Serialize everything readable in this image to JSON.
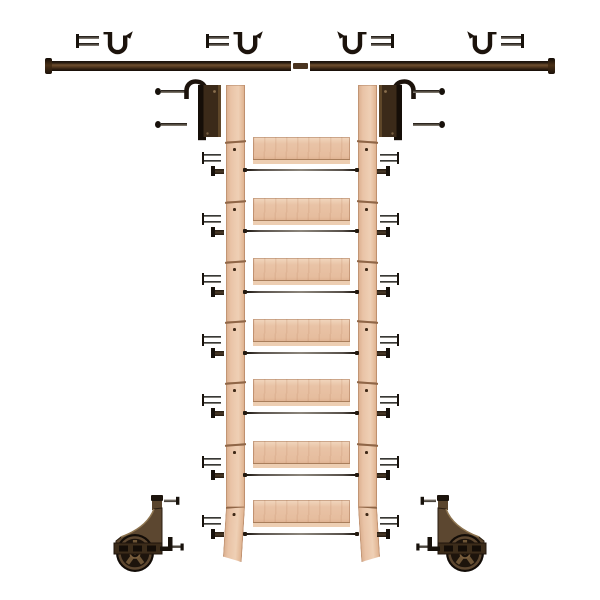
{
  "product": {
    "name": "rolling-library-ladder-hardware-kit",
    "background": "#ffffff"
  },
  "colors": {
    "hardware_dark": "#17110b",
    "hardware_mid": "#45301c",
    "rail_highlight": "#6f4f30",
    "bronze_light": "#77603f",
    "bronze_mid": "#55402a",
    "bronze_dark": "#2a1d10",
    "wood_mid": "#e9c3a6",
    "wood_light": "#f2d7bf",
    "wood_dark": "#d0a17e",
    "wheel": "#16100a"
  },
  "rail": {
    "sections": 2,
    "connectors": 1,
    "end_caps": 2,
    "mounting_brackets": 4,
    "screws_per_bracket": 2
  },
  "ladder": {
    "steps": 7,
    "support_rods": 7,
    "side_rails": 2,
    "segments_per_side_rail": 8,
    "fastener_sets_per_side": 7,
    "screws_per_set": 2,
    "bolts_per_set": 1
  },
  "hooks": {
    "count": 2,
    "screws_each": 2
  },
  "rollers": {
    "count": 2,
    "screws_each": 2,
    "angle_brackets_each": 1,
    "wheel_spokes": 5
  },
  "parts": {
    "scene": "rolling library ladder kit parts layout",
    "rail_bracket": "rail mounting bracket",
    "bracket_screw": "bracket screw",
    "rail": "sliding rail section",
    "rail_connector": "rail connector",
    "rail_end_cap": "rail end cap",
    "hook_plate": "ladder hook plate",
    "hook_screw": "hook mounting screw",
    "side_rail": "ladder side rail",
    "rail_segment": "side rail segment",
    "step": "ladder step",
    "rod": "step support rod",
    "step_screw": "step screw",
    "step_bolt": "step barrel bolt",
    "roller": "roller wheel assembly",
    "roller_screw": "roller mounting screw",
    "roller_bracket": "roller angle bracket",
    "wheel": "spoked roller wheel"
  }
}
